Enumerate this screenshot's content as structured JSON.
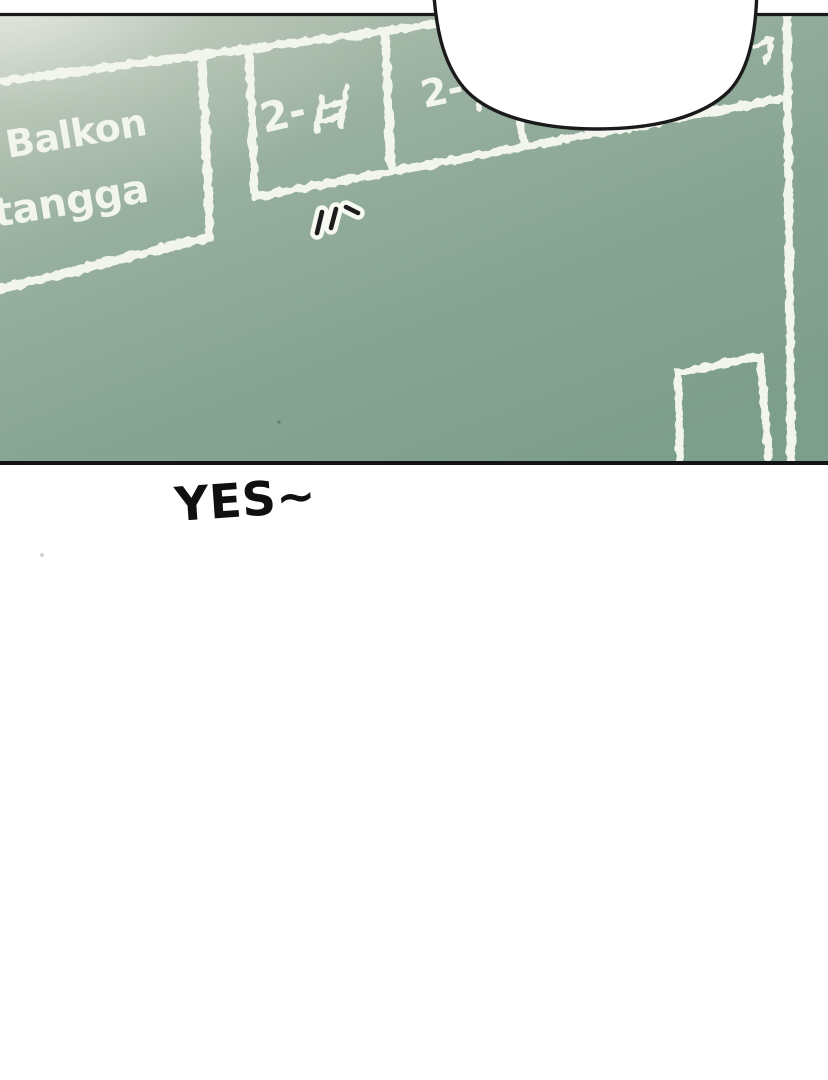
{
  "colors": {
    "page_bg": "#ffffff",
    "panel_border": "#1a1a1a",
    "chalk": "#f2f5ed",
    "board_top_left": "#cdd3c4",
    "board_mid": "#93ac9c",
    "board_bottom_right": "#7d9e8b",
    "bubble_fill": "#ffffff",
    "bubble_outline": "#1a1a1a",
    "dialogue_text": "#101010",
    "emphasis_mark_core": "#1c1c1c",
    "emphasis_mark_halo": "#f6f8f2"
  },
  "chalkboard": {
    "room_label_line1": "Balkon",
    "room_label_line2": "tangga",
    "unit1_prefix": "2-",
    "unit1_full_label": "2-ㅂ",
    "unit2_prefix": "2-"
  },
  "emphasis_marks": {
    "count": 3
  },
  "dialogue": {
    "text": "YES~"
  }
}
